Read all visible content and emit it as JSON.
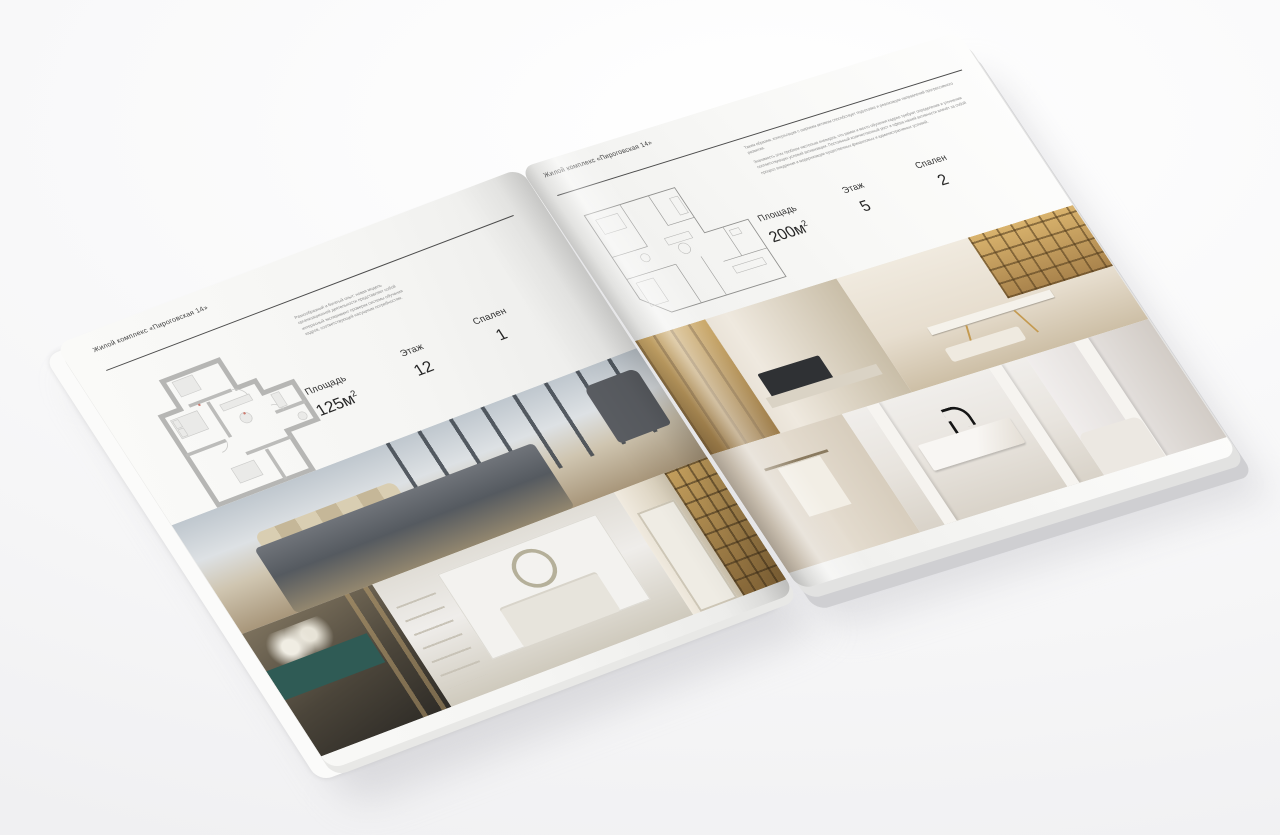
{
  "brand": "Жилой комплекс «Пироговская 14»",
  "left_page": {
    "header": "Жилой комплекс «Пироговская 14»",
    "description": "Разнообразный и богатый опыт: новая модель организационной деятельности представляет собой интересный эксперимент проверки системы обучения кадров, соответствующей насущным потребностям.",
    "specs": [
      {
        "label": "Площадь",
        "value": "125м",
        "sup": "2"
      },
      {
        "label": "Этаж",
        "value": "12",
        "sup": ""
      },
      {
        "label": "Спален",
        "value": "1",
        "sup": ""
      }
    ],
    "floorplan": "apartment-plan-125m2-thick-gray-walls",
    "photos": [
      "master-bedroom-city-view",
      "teal-console-with-flowers",
      "white-bedroom-with-wreath",
      "library-hallway"
    ]
  },
  "right_page": {
    "header": "Жилой комплекс «Пироговская 14»",
    "description_1": "Таким образом, консультация с широким активом способствует подготовке и реализации направлений прогрессивного развития.",
    "description_2": "Значимость этих проблем настолько очевидна, что рамки и место обучения кадров требуют определения и уточнения соответствующих условий активизации. Постоянный количественный рост и сфера нашей активности влечёт за собой процесс внедрения и модернизации существенных финансовых и административных условий.",
    "specs": [
      {
        "label": "Площадь",
        "value": "200м",
        "sup": "2"
      },
      {
        "label": "Этаж",
        "value": "5",
        "sup": ""
      },
      {
        "label": "Спален",
        "value": "2",
        "sup": ""
      }
    ],
    "floorplan": "apartment-plan-200m2-thin-lines",
    "photos": [
      "wardrobe-hallway",
      "dressing-room-display-cabinets",
      "bathroom-towel-rail",
      "marble-vanity-black-faucet",
      "light-partition-room"
    ]
  }
}
